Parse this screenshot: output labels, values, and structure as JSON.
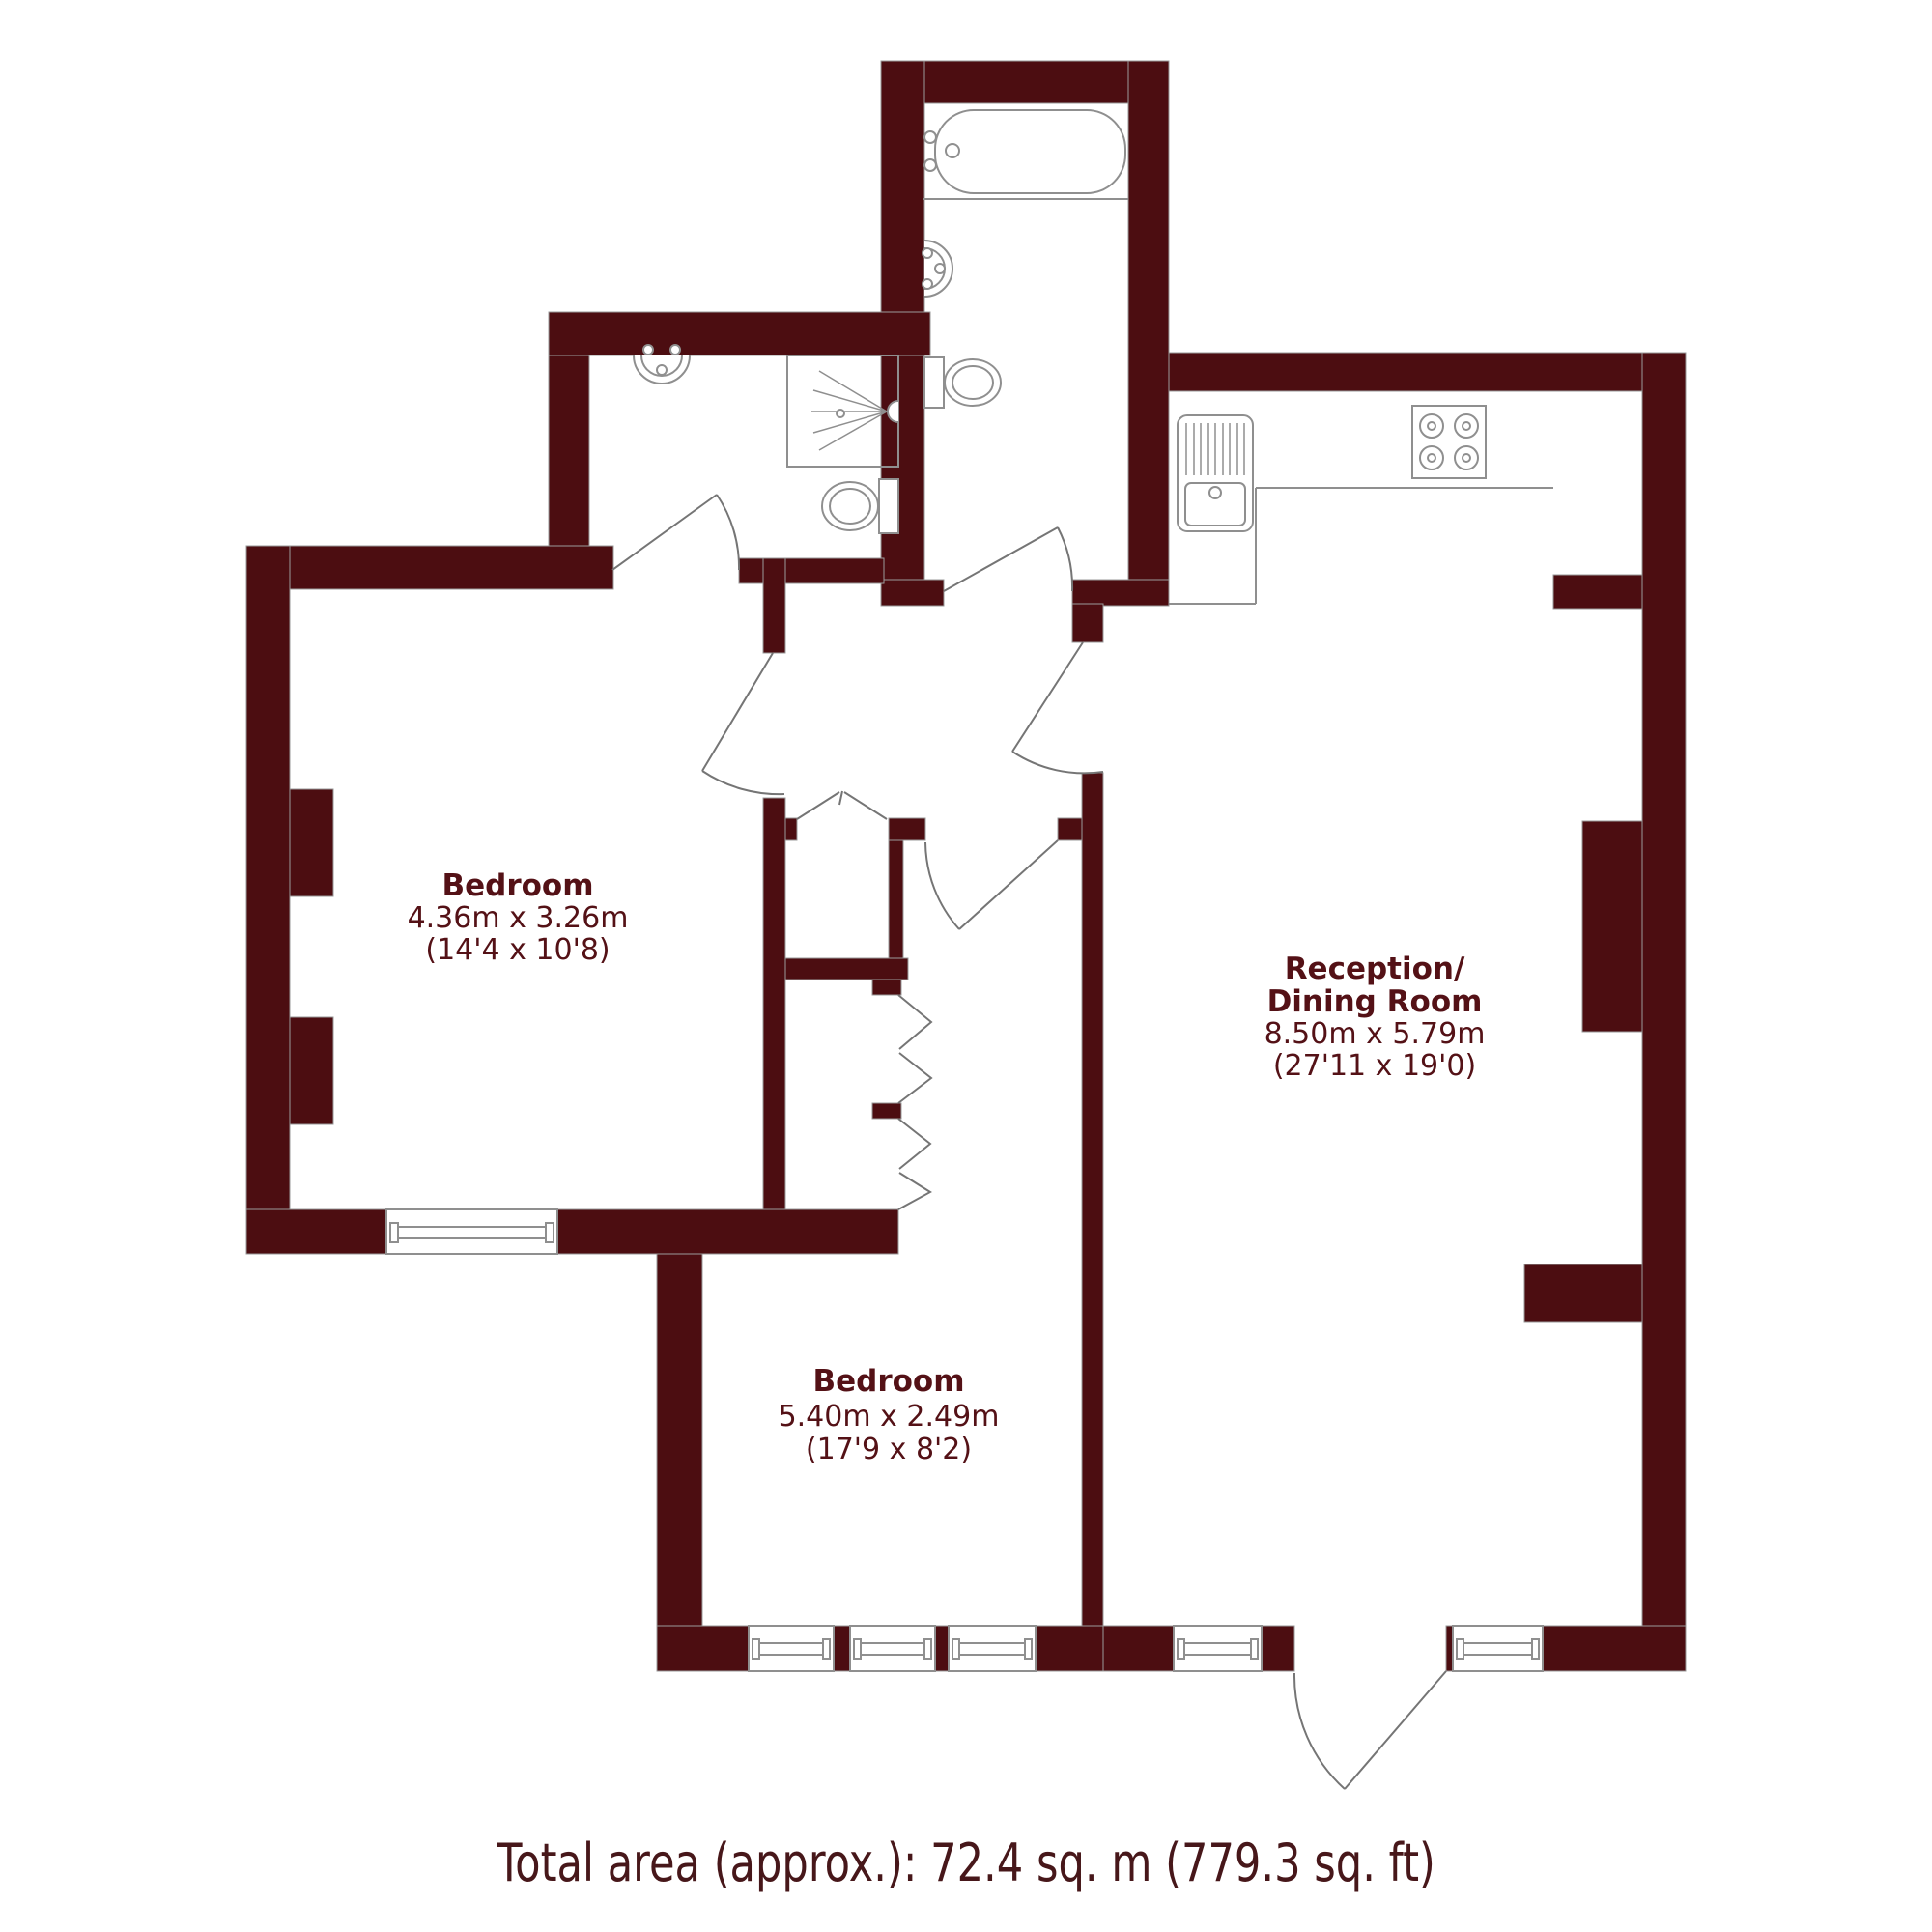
{
  "title": "Flat floor plan",
  "colors": {
    "wall": "#4c0d11",
    "fixture_line": "#8f8f8f",
    "door_line": "#757575",
    "label_text": "#541116",
    "footer_text": "#47171a",
    "background": "#ffffff"
  },
  "rooms": {
    "bedroom1": {
      "name": "Bedroom",
      "dims_m": "4.36m x 3.26m",
      "dims_ft": "(14'4 x 10'8)"
    },
    "bedroom2": {
      "name": "Bedroom",
      "dims_m": "5.40m x 2.49m",
      "dims_ft": "(17'9 x 8'2)"
    },
    "reception": {
      "name_line1": "Reception/",
      "name_line2": "Dining Room",
      "dims_m": "8.50m x 5.79m",
      "dims_ft": "(27'11 x 19'0)"
    }
  },
  "fixtures": [
    "bathtub",
    "bathroom-sink",
    "bathroom-toilet",
    "ensuite-sink",
    "shower-enclosure",
    "shower-head",
    "ensuite-toilet",
    "kitchen-sink-unit",
    "kitchen-counter",
    "kitchen-hob",
    "closet-bifold-doors",
    "wardrobe-bifold-doors",
    "windows",
    "door-swings"
  ],
  "footer": {
    "total_area": "Total area (approx.): 72.4 sq. m (779.3 sq. ft)"
  }
}
